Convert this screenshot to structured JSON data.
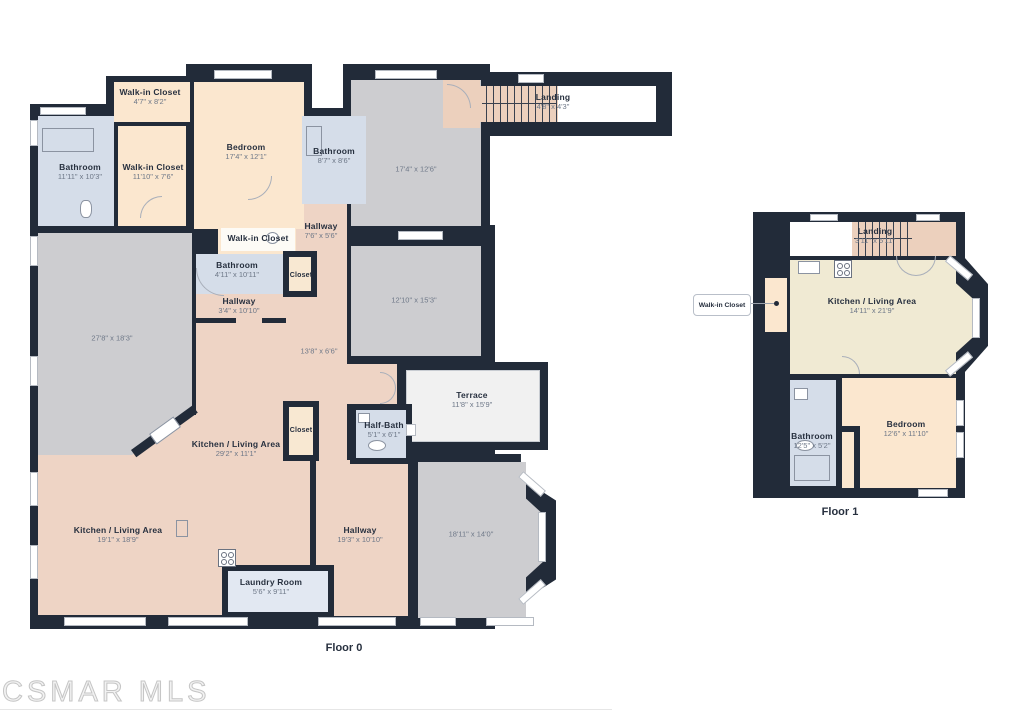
{
  "watermark": "CSMAR MLS",
  "colors": {
    "wall": "#222b39",
    "room_peach": "#fbe7cf",
    "room_salmon": "#eed4c5",
    "room_blue": "#d5dde9",
    "room_gray": "#cdcdd0",
    "room_cream": "#f0ead3",
    "terrace": "#f1f1f1",
    "laundry": "#e2e8f2",
    "stairs": "#ecd0bd",
    "label_name": "#27303f",
    "label_dims": "#6e7888"
  },
  "floor0": {
    "label": "Floor 0",
    "rooms": {
      "bathroom_tl": {
        "name": "Bathroom",
        "dims": "11'11\" x 10'3\""
      },
      "wic_top": {
        "name": "Walk-in Closet",
        "dims": "4'7\" x 8'2\""
      },
      "wic_left": {
        "name": "Walk-in Closet",
        "dims": "11'10\" x 7'6\""
      },
      "bedroom": {
        "name": "Bedroom",
        "dims": "17'4\" x 12'1\""
      },
      "bathroom_top": {
        "name": "Bathroom",
        "dims": "8'7\" x 8'6\""
      },
      "room_a": {
        "dims": "17'4\" x 12'6\""
      },
      "landing": {
        "name": "Landing",
        "dims": "4'8\" x 4'3\""
      },
      "hallway_top": {
        "name": "Hallway",
        "dims": "7'6\" x 5'6\""
      },
      "wic_mid": {
        "name": "Walk-in Closet"
      },
      "bathroom_mid": {
        "name": "Bathroom",
        "dims": "4'11\" x 10'11\""
      },
      "closet_mid": {
        "name": "Closet"
      },
      "hallway_mid": {
        "name": "Hallway",
        "dims": "3'4\" x 10'10\""
      },
      "room_b": {
        "dims": "12'10\" x 15'3\""
      },
      "room_c": {
        "dims": "27'8\" x 18'3\""
      },
      "corridor": {
        "dims": "13'8\" x 6'6\""
      },
      "terrace": {
        "name": "Terrace",
        "dims": "11'8\" x 15'9\""
      },
      "half_bath": {
        "name": "Half-Bath",
        "dims": "5'1\" x 6'1\""
      },
      "closet_low": {
        "name": "Closet"
      },
      "kitchen_band": {
        "name": "Kitchen / Living Area",
        "dims": "29'2\" x 11'1\""
      },
      "kitchen_main": {
        "name": "Kitchen / Living Area",
        "dims": "19'1\" x 18'9\""
      },
      "hallway_low": {
        "name": "Hallway",
        "dims": "19'3\" x 10'10\""
      },
      "room_d": {
        "dims": "18'11\" x 14'0\""
      },
      "laundry": {
        "name": "Laundry Room",
        "dims": "5'6\" x 9'11\""
      }
    }
  },
  "floor1": {
    "label": "Floor 1",
    "rooms": {
      "landing": {
        "name": "Landing",
        "dims": "3'11\" x 5'11\""
      },
      "wic_callout": {
        "name": "Walk-in Closet"
      },
      "kitchen": {
        "name": "Kitchen / Living Area",
        "dims": "14'11\" x 21'9\""
      },
      "bathroom": {
        "name": "Bathroom",
        "dims": "12'5\" x 5'2\""
      },
      "bedroom": {
        "name": "Bedroom",
        "dims": "12'6\" x 11'10\""
      }
    }
  }
}
